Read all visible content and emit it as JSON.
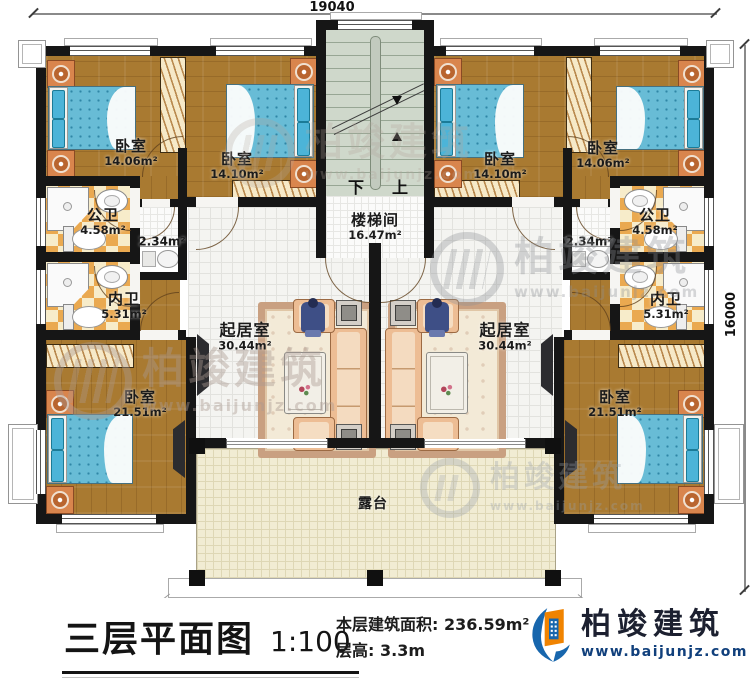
{
  "dimensions": {
    "top": "19040",
    "right": "16000"
  },
  "stairwell": {
    "label": "楼梯间",
    "area": "16.47m²",
    "down": "下",
    "up": "上"
  },
  "rooms": {
    "bedroom_tl": {
      "label": "卧室",
      "area": "14.06m²"
    },
    "bedroom_tl2": {
      "label": "卧室",
      "area": "14.10m²"
    },
    "bedroom_tr2": {
      "label": "卧室",
      "area": "14.10m²"
    },
    "bedroom_tr": {
      "label": "卧室",
      "area": "14.06m²"
    },
    "pub_bath_left": {
      "label": "公卫",
      "area": "4.58m²"
    },
    "pub_bath_right": {
      "label": "公卫",
      "area": "4.58m²"
    },
    "closet_left": {
      "area": "2.34m²"
    },
    "closet_right": {
      "area": "2.34m²"
    },
    "priv_bath_left": {
      "label": "内卫",
      "area": "5.31m²"
    },
    "priv_bath_right": {
      "label": "内卫",
      "area": "5.31m²"
    },
    "bedroom_bl": {
      "label": "卧室",
      "area": "21.51m²"
    },
    "bedroom_br": {
      "label": "卧室",
      "area": "21.51m²"
    },
    "living_left": {
      "label": "起居室",
      "area": "30.44m²"
    },
    "living_right": {
      "label": "起居室",
      "area": "30.44m²"
    },
    "terrace": {
      "label": "露台"
    }
  },
  "title_block": {
    "title": "三层平面图",
    "scale": "1:100",
    "area_label": "本层建筑面积:",
    "area_value": "236.59m²",
    "height_label": "层高:",
    "height_value": "3.3m"
  },
  "brand": {
    "name": "柏竣建筑",
    "website": "www.baijunjz.com"
  },
  "watermark": {
    "name": "柏竣建筑",
    "website": "www.baijunjz.com"
  },
  "colors": {
    "wall": "#161616",
    "wood": "#a97a31",
    "tile": "#f4f4f1",
    "checker_a": "#eaa950",
    "checker_b": "#f7ecca",
    "stair": "#cfd8cb",
    "terrace": "#f1ecd3",
    "bed": "#68bcd6",
    "accent_blue": "#1766ad",
    "accent_orange": "#f08300",
    "brand_text": "#1c2030"
  }
}
